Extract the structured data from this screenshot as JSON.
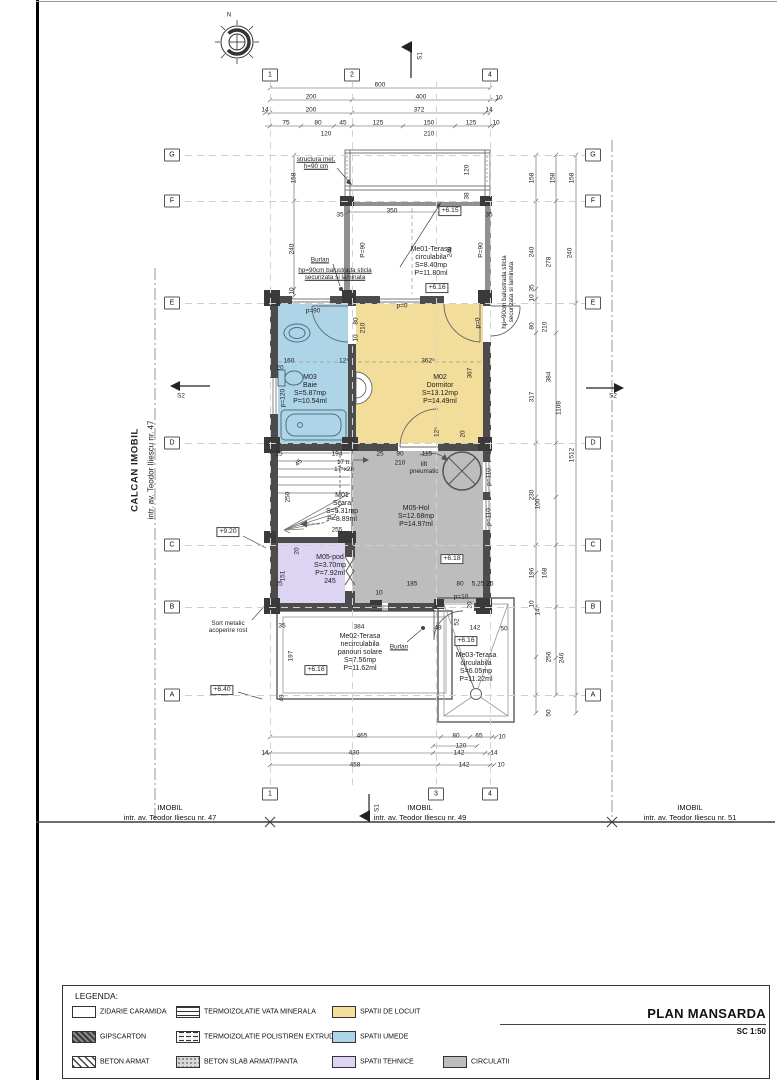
{
  "sheet": {
    "title": "PLAN MANSARDA",
    "scale": "SC 1:50"
  },
  "colors": {
    "locuit": "#f3dd9a",
    "umede": "#aed4e8",
    "tehnice": "#dcd4f2",
    "circulatii": "#bdbdbd",
    "wall": "#4c4c4c",
    "terrace_wall": "#909090"
  },
  "legend": {
    "heading": "LEGENDA:",
    "items": [
      {
        "label": "ZIDARIE CARAMIDA",
        "key": "brick",
        "col": 0,
        "row": 0
      },
      {
        "label": "GIPSCARTON",
        "key": "gips",
        "col": 0,
        "row": 1
      },
      {
        "label": "BETON ARMAT",
        "key": "beton",
        "col": 0,
        "row": 2
      },
      {
        "label": "TERMOIZOLATIE VATA MINERALA",
        "key": "vata",
        "col": 1,
        "row": 0
      },
      {
        "label": "TERMOIZOLATIE POLISTIREN EXTRUDAT",
        "key": "polistiren",
        "col": 1,
        "row": 1
      },
      {
        "label": "BETON SLAB ARMAT/PANTA",
        "key": "slab",
        "col": 1,
        "row": 2
      },
      {
        "label": "SPATII DE LOCUIT",
        "key": "locuit",
        "col": 2,
        "row": 0
      },
      {
        "label": "SPATII UMEDE",
        "key": "umede",
        "col": 2,
        "row": 1
      },
      {
        "label": "SPATII TEHNICE",
        "key": "tehnice",
        "col": 2,
        "row": 2
      },
      {
        "label": "CIRCULATII",
        "key": "circulatii",
        "col": 3,
        "row": 2
      }
    ]
  },
  "grid": {
    "rows": [
      {
        "l": "G",
        "y": 155
      },
      {
        "l": "F",
        "y": 201
      },
      {
        "l": "E",
        "y": 303
      },
      {
        "l": "D",
        "y": 443
      },
      {
        "l": "C",
        "y": 545
      },
      {
        "l": "B",
        "y": 607
      },
      {
        "l": "A",
        "y": 695
      }
    ],
    "cols_top": [
      {
        "l": "1",
        "x": 270
      },
      {
        "l": "2",
        "x": 352
      },
      {
        "l": "4",
        "x": 490
      }
    ],
    "cols_bottom": [
      {
        "l": "1",
        "x": 270
      },
      {
        "l": "3",
        "x": 436
      },
      {
        "l": "4",
        "x": 490
      }
    ],
    "col_lines": [
      270,
      352,
      436,
      490
    ]
  },
  "site": [
    {
      "l1": "IMOBIL",
      "l2": "intr. av. Teodor Iliescu nr. 47",
      "x": 170
    },
    {
      "l1": "IMOBIL",
      "l2": "intr. av. Teodor Iliescu nr. 49",
      "x": 420
    },
    {
      "l1": "IMOBIL",
      "l2": "intr. av. Teodor Iliescu nr. 51",
      "x": 690
    }
  ],
  "texts": [
    {
      "t": "600",
      "x": 380,
      "y": 85
    },
    {
      "t": "200",
      "x": 311,
      "y": 97
    },
    {
      "t": "400",
      "x": 421,
      "y": 97
    },
    {
      "t": "10",
      "x": 499,
      "y": 98
    },
    {
      "t": "14",
      "x": 265,
      "y": 110
    },
    {
      "t": "200",
      "x": 311,
      "y": 110
    },
    {
      "t": "372",
      "x": 419,
      "y": 110
    },
    {
      "t": "14",
      "x": 489,
      "y": 110
    },
    {
      "t": "75",
      "x": 286,
      "y": 123
    },
    {
      "t": "80",
      "x": 318,
      "y": 123
    },
    {
      "t": "45",
      "x": 343,
      "y": 123
    },
    {
      "t": "125",
      "x": 378,
      "y": 123
    },
    {
      "t": "150",
      "x": 429,
      "y": 123
    },
    {
      "t": "125",
      "x": 471,
      "y": 123
    },
    {
      "t": "10",
      "x": 496,
      "y": 123
    },
    {
      "t": "120",
      "x": 326,
      "y": 134
    },
    {
      "t": "210",
      "x": 429,
      "y": 134
    },
    {
      "t": "structura met.\nh=90 cm",
      "x": 316,
      "y": 163,
      "c": "o u",
      "n": "note-structura-met"
    },
    {
      "t": "120",
      "x": 467,
      "y": 170,
      "r": -90
    },
    {
      "t": "38",
      "x": 467,
      "y": 196,
      "r": -90
    },
    {
      "t": "35",
      "x": 340,
      "y": 215
    },
    {
      "t": "350",
      "x": 392,
      "y": 211
    },
    {
      "t": "35",
      "x": 489,
      "y": 215
    },
    {
      "t": "+6.15",
      "x": 450,
      "y": 211,
      "c": "b",
      "n": "elevation-marker"
    },
    {
      "t": "hp=90cm balustrada sticla\nsecurizata si laminata",
      "x": 335,
      "y": 274,
      "c": "o u",
      "n": "note-balustrada"
    },
    {
      "t": "P=90",
      "x": 363,
      "y": 250,
      "r": -90
    },
    {
      "t": "P=90",
      "x": 481,
      "y": 250,
      "r": -90
    },
    {
      "t": "240",
      "x": 450,
      "y": 252,
      "r": -90
    },
    {
      "t": "Me01-Terasa\ncirculabila\nS=8.40mp\nP=11.80ml",
      "x": 431,
      "y": 262,
      "c": "rm",
      "n": "room-label-me01"
    },
    {
      "t": "Burlan",
      "x": 320,
      "y": 260,
      "c": "o u",
      "n": "note-burlan-1"
    },
    {
      "t": "+6.16",
      "x": 437,
      "y": 288,
      "c": "b",
      "n": "elevation-marker"
    },
    {
      "t": "hp=90cm balustrada sticla\nsecurizata si laminata",
      "x": 508,
      "y": 292,
      "r": -90,
      "c": "o",
      "n": "note-balustrada-right"
    },
    {
      "t": "158",
      "x": 294,
      "y": 178,
      "r": -90
    },
    {
      "t": "240",
      "x": 292,
      "y": 249,
      "r": -90
    },
    {
      "t": "10",
      "x": 292,
      "y": 291,
      "r": -90
    },
    {
      "t": "p=90",
      "x": 313,
      "y": 311
    },
    {
      "t": "p=0",
      "x": 402,
      "y": 306
    },
    {
      "t": "p=0",
      "x": 478,
      "y": 323,
      "r": -90
    },
    {
      "t": "80",
      "x": 356,
      "y": 321,
      "r": -90
    },
    {
      "t": "210",
      "x": 363,
      "y": 328,
      "r": -90
    },
    {
      "t": "10",
      "x": 356,
      "y": 338,
      "r": -90
    },
    {
      "t": "160",
      "x": 289,
      "y": 361
    },
    {
      "t": "12⁵",
      "x": 344,
      "y": 361
    },
    {
      "t": "20",
      "x": 280,
      "y": 368
    },
    {
      "t": "362⁵",
      "x": 428,
      "y": 361
    },
    {
      "t": "367",
      "x": 470,
      "y": 373,
      "r": -90
    },
    {
      "t": "M03\nBaie\nS=5.87mp\nP=10.54ml",
      "x": 310,
      "y": 390,
      "c": "rm",
      "n": "room-label-m03"
    },
    {
      "t": "M02\nDormitor\nS=13.12mp\nP=14.49ml",
      "x": 440,
      "y": 390,
      "c": "rm",
      "n": "room-label-m02"
    },
    {
      "t": "p=120",
      "x": 283,
      "y": 398,
      "r": -90
    },
    {
      "t": "12⁵",
      "x": 437,
      "y": 432,
      "r": -90
    },
    {
      "t": "20",
      "x": 463,
      "y": 434,
      "r": -90
    },
    {
      "t": "25",
      "x": 279,
      "y": 454
    },
    {
      "t": "194",
      "x": 337,
      "y": 454
    },
    {
      "t": "45",
      "x": 299,
      "y": 463,
      "r": -45
    },
    {
      "t": "17 tr.\n17⁵x28",
      "x": 344,
      "y": 466,
      "c": "o",
      "n": "note-stair-treads"
    },
    {
      "t": "250",
      "x": 288,
      "y": 497,
      "r": -90
    },
    {
      "t": "M01\nScara\nS=5.31mp\nP=8.89ml",
      "x": 342,
      "y": 508,
      "c": "rm",
      "n": "room-label-m01"
    },
    {
      "t": "255",
      "x": 337,
      "y": 530
    },
    {
      "t": "25",
      "x": 380,
      "y": 454
    },
    {
      "t": "90",
      "x": 400,
      "y": 454
    },
    {
      "t": "210",
      "x": 400,
      "y": 463
    },
    {
      "t": "115",
      "x": 427,
      "y": 454
    },
    {
      "t": "lift\npneumatic",
      "x": 424,
      "y": 468,
      "c": "o",
      "n": "note-lift"
    },
    {
      "t": "M05-Hol\nS=12.68mp\nP=14.97ml",
      "x": 416,
      "y": 517,
      "c": "rm",
      "n": "room-label-m05"
    },
    {
      "t": "p=110",
      "x": 489,
      "y": 477,
      "r": -90
    },
    {
      "t": "p=110",
      "x": 489,
      "y": 517,
      "r": -90
    },
    {
      "t": "+6.18",
      "x": 452,
      "y": 559,
      "c": "b",
      "n": "elevation-marker"
    },
    {
      "t": "20",
      "x": 297,
      "y": 551,
      "r": -90
    },
    {
      "t": "151",
      "x": 283,
      "y": 576,
      "r": -90
    },
    {
      "t": "25",
      "x": 279,
      "y": 584
    },
    {
      "t": "M05-pod\nS=3.70mp\nP=7.92ml\n245",
      "x": 330,
      "y": 570,
      "c": "rm",
      "n": "room-label-pod"
    },
    {
      "t": "185",
      "x": 412,
      "y": 584
    },
    {
      "t": "80",
      "x": 460,
      "y": 584
    },
    {
      "t": "5,25",
      "x": 478,
      "y": 584
    },
    {
      "t": "25",
      "x": 490,
      "y": 584
    },
    {
      "t": "10",
      "x": 379,
      "y": 593
    },
    {
      "t": "p=10",
      "x": 461,
      "y": 597
    },
    {
      "t": "20",
      "x": 470,
      "y": 605,
      "r": -90
    },
    {
      "t": "35",
      "x": 282,
      "y": 626
    },
    {
      "t": "384",
      "x": 359,
      "y": 627
    },
    {
      "t": "49",
      "x": 438,
      "y": 628
    },
    {
      "t": "52",
      "x": 457,
      "y": 622,
      "r": -90
    },
    {
      "t": "142",
      "x": 475,
      "y": 628
    },
    {
      "t": "50",
      "x": 504,
      "y": 629
    },
    {
      "t": "+6.16",
      "x": 466,
      "y": 641,
      "c": "b",
      "n": "elevation-marker"
    },
    {
      "t": "Burlan",
      "x": 399,
      "y": 647,
      "c": "o u",
      "n": "note-burlan-2"
    },
    {
      "t": "197",
      "x": 291,
      "y": 656,
      "r": -90
    },
    {
      "t": "Me02-Terasa\nnecirculabila\npanouri solare\nS=7.56mp\nP=11.62ml",
      "x": 360,
      "y": 653,
      "c": "rm",
      "n": "room-label-me02"
    },
    {
      "t": "+6.16",
      "x": 316,
      "y": 670,
      "c": "b",
      "n": "elevation-marker"
    },
    {
      "t": "Me03-Terasa\ncirculabila\nS=6.05mp\nP=11.22ml",
      "x": 476,
      "y": 668,
      "c": "rm",
      "n": "room-label-me03"
    },
    {
      "t": "49",
      "x": 282,
      "y": 698,
      "r": -90
    },
    {
      "t": "+9.20",
      "x": 228,
      "y": 532,
      "c": "b",
      "n": "elevation-marker"
    },
    {
      "t": "+6.40",
      "x": 222,
      "y": 690,
      "c": "b",
      "n": "elevation-marker"
    },
    {
      "t": "Sort metalic\nacoperire rost",
      "x": 228,
      "y": 627,
      "c": "o",
      "n": "note-sort-metalic"
    },
    {
      "t": "CALCAN IMOBIL",
      "x": 136,
      "y": 470,
      "r": -90,
      "c": "v",
      "n": "label-calcan-imobil"
    },
    {
      "t": "intr. av. Teodor Iliescu nr. 47",
      "x": 151,
      "y": 470,
      "r": -90,
      "c": "v2",
      "n": "label-intr-47-vertical"
    },
    {
      "t": "S1",
      "x": 420,
      "y": 56,
      "r": -90,
      "c": "o",
      "n": "section-label-s1-top"
    },
    {
      "t": "S1",
      "x": 377,
      "y": 808,
      "r": -90,
      "c": "o",
      "n": "section-label-s1-bottom"
    },
    {
      "t": "S2",
      "x": 181,
      "y": 396,
      "c": "o",
      "n": "section-label-s2-left"
    },
    {
      "t": "S2",
      "x": 613,
      "y": 396,
      "c": "o",
      "n": "section-label-s2-right"
    },
    {
      "t": "N",
      "x": 229,
      "y": 15,
      "c": "o",
      "n": "compass-north-label"
    },
    {
      "t": "465",
      "x": 362,
      "y": 736
    },
    {
      "t": "80",
      "x": 456,
      "y": 736
    },
    {
      "t": "65",
      "x": 479,
      "y": 736
    },
    {
      "t": "10",
      "x": 502,
      "y": 737
    },
    {
      "t": "120",
      "x": 461,
      "y": 746
    },
    {
      "t": "14",
      "x": 265,
      "y": 753
    },
    {
      "t": "430",
      "x": 354,
      "y": 753
    },
    {
      "t": "142",
      "x": 459,
      "y": 753
    },
    {
      "t": "14",
      "x": 494,
      "y": 753
    },
    {
      "t": "458",
      "x": 355,
      "y": 765
    },
    {
      "t": "142",
      "x": 464,
      "y": 765
    },
    {
      "t": "10",
      "x": 501,
      "y": 765
    },
    {
      "t": "158",
      "x": 532,
      "y": 178,
      "r": -90
    },
    {
      "t": "240",
      "x": 532,
      "y": 252,
      "r": -90
    },
    {
      "t": "35",
      "x": 532,
      "y": 288,
      "r": -90
    },
    {
      "t": "10",
      "x": 532,
      "y": 298,
      "r": -90
    },
    {
      "t": "80",
      "x": 532,
      "y": 326,
      "r": -90
    },
    {
      "t": "317",
      "x": 532,
      "y": 397,
      "r": -90
    },
    {
      "t": "230",
      "x": 532,
      "y": 495,
      "r": -90
    },
    {
      "t": "100",
      "x": 538,
      "y": 504,
      "r": -90
    },
    {
      "t": "196",
      "x": 532,
      "y": 573,
      "r": -90
    },
    {
      "t": "10",
      "x": 532,
      "y": 604,
      "r": -90
    },
    {
      "t": "14",
      "x": 538,
      "y": 612,
      "r": -90
    },
    {
      "t": "256",
      "x": 549,
      "y": 657,
      "r": -90
    },
    {
      "t": "50",
      "x": 549,
      "y": 713,
      "r": -90
    },
    {
      "t": "158",
      "x": 553,
      "y": 178,
      "r": -90
    },
    {
      "t": "278",
      "x": 549,
      "y": 262,
      "r": -90
    },
    {
      "t": "210",
      "x": 545,
      "y": 327,
      "r": -90
    },
    {
      "t": "384",
      "x": 549,
      "y": 377,
      "r": -90
    },
    {
      "t": "1108",
      "x": 559,
      "y": 408,
      "r": -90
    },
    {
      "t": "168",
      "x": 545,
      "y": 573,
      "r": -90
    },
    {
      "t": "246",
      "x": 562,
      "y": 658,
      "r": -90
    },
    {
      "t": "158",
      "x": 572,
      "y": 178,
      "r": -90
    },
    {
      "t": "240",
      "x": 570,
      "y": 253,
      "r": -90
    },
    {
      "t": "1512",
      "x": 572,
      "y": 455,
      "r": -90
    }
  ]
}
